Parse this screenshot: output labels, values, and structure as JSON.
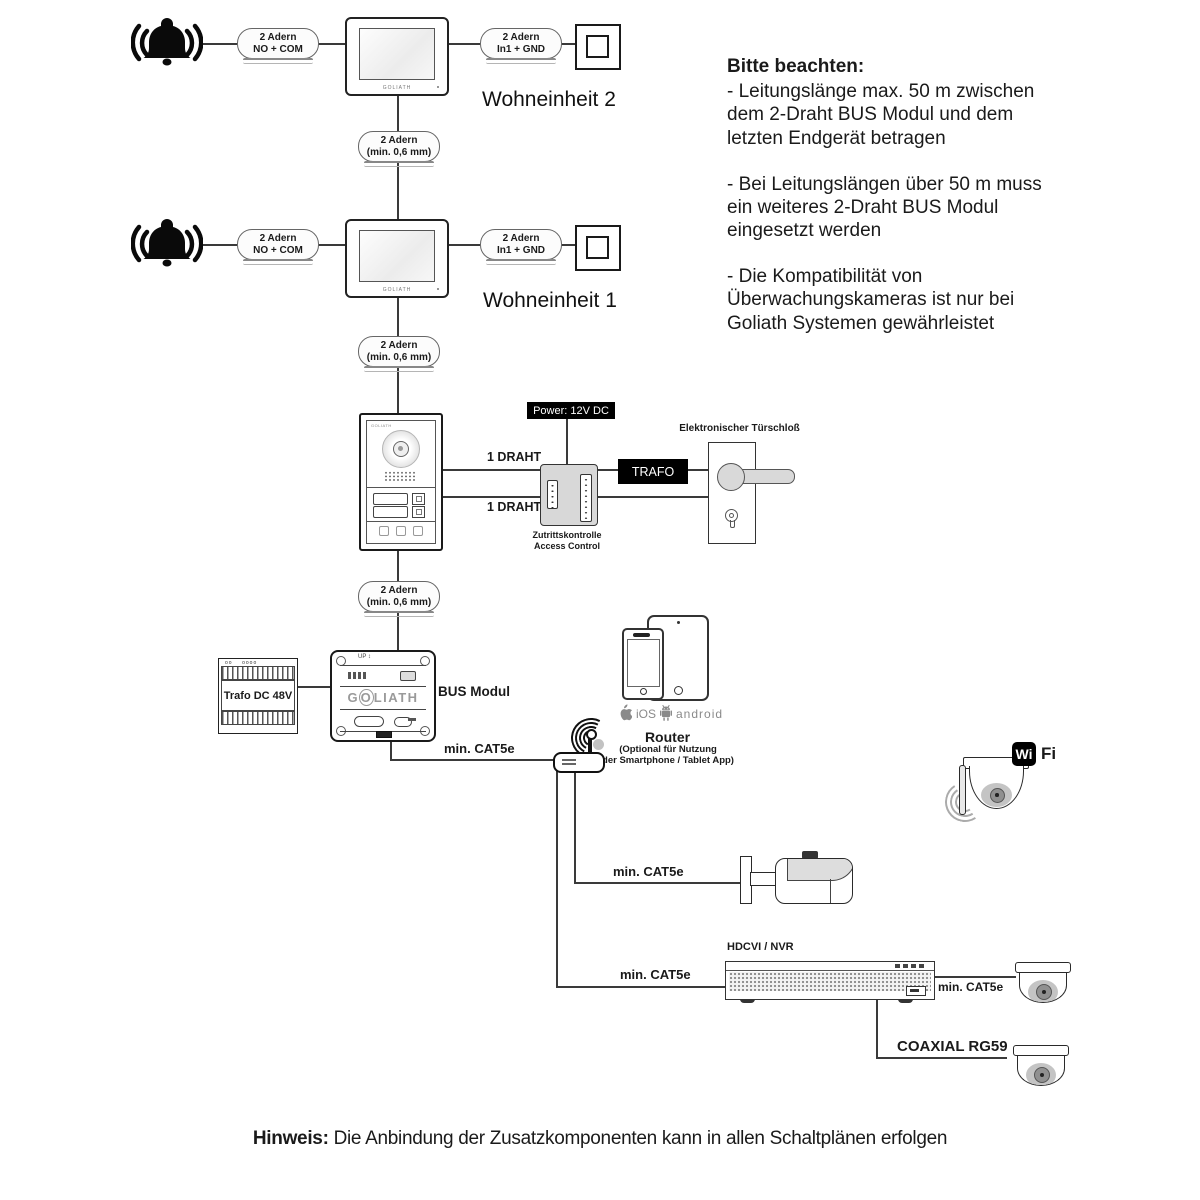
{
  "units": {
    "unit2": "Wohneinheit 2",
    "unit1": "Wohneinheit 1"
  },
  "wire_labels": {
    "no_com": {
      "line1": "2 Adern",
      "line2": "NO + COM"
    },
    "in1_gnd": {
      "line1": "2 Adern",
      "line2": "In1 + GND"
    },
    "min06": {
      "line1": "2 Adern",
      "line2": "(min. 0,6 mm)"
    },
    "draht": "1 DRAHT",
    "cat5e": "min. CAT5e",
    "coaxial": "COAXIAL RG59"
  },
  "devices": {
    "power_label": "Power: 12V DC",
    "trafo_box": "TRAFO",
    "access_line1": "Zutrittskontrolle",
    "access_line2": "Access Control",
    "lock_label": "Elektronischer Türschloß",
    "trafo48": "Trafo DC 48V",
    "bus_modul": "BUS Modul",
    "bus_up": "UP",
    "goliath": "GOLIATH",
    "hdcvi": "HDCVI / NVR",
    "router": "Router",
    "router_opt1": "(Optional für Nutzung",
    "router_opt2": "der Smartphone / Tablet App)",
    "ios": "iOS",
    "android": "android",
    "wifi_wi": "Wi",
    "wifi_fi": "Fi"
  },
  "notes": {
    "title": "Bitte beachten:",
    "items": [
      "- Leitungslänge max. 50 m zwischen dem 2-Draht BUS Modul und dem letzten Endgerät betragen",
      "- Bei Leitungslängen über 50 m muss ein weiteres 2-Draht BUS Modul eingesetzt werden",
      "- Die Kompatibilität von Überwachungskameras ist nur bei Goliath Systemen gewährleistet"
    ]
  },
  "footer": {
    "bold": "Hinweis:",
    "text": " Die Anbindung der Zusatzkomponenten kann in allen Schaltplänen erfolgen"
  },
  "colors": {
    "wire": "#3a3a3a",
    "device_stroke": "#1a1a1a",
    "gray_fill": "#d8d8d8",
    "label_bg": "#000000"
  }
}
